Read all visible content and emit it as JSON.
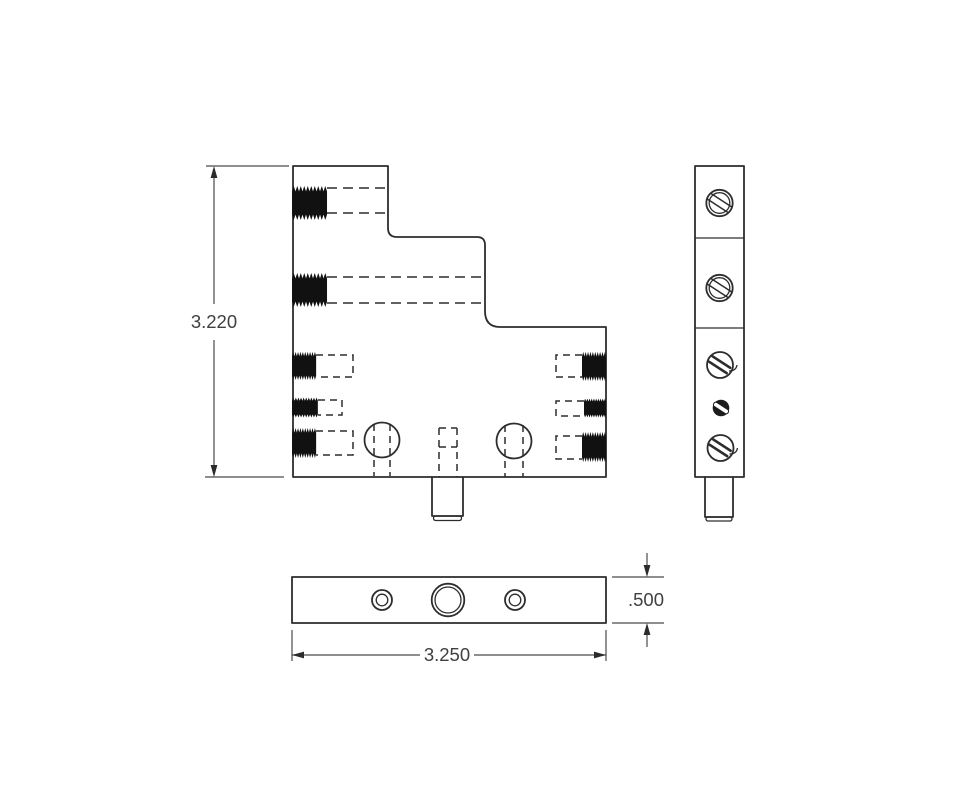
{
  "drawing": {
    "colors": {
      "line": "#2d2d2d",
      "text": "#404040",
      "background": "#ffffff"
    },
    "dimensions": {
      "height": "3.220",
      "thickness": ".500",
      "width": "3.250"
    }
  }
}
